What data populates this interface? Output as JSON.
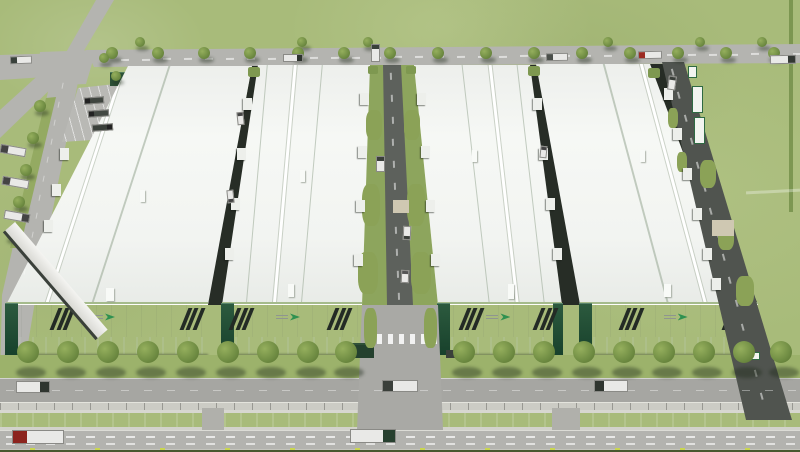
{
  "meta": {
    "label": "Aerial 3D rendering of a logistics industrial park: four white warehouses with dark striped facades and green logo marks, service roads with loading docks and trucks, tree-lined frontage road, concrete wall, teal drainage canal and a main highway"
  },
  "palette": {
    "grass": "#a8bb7a",
    "road_light": "#b4b4b0",
    "road_dark": "#5d615c",
    "roof": "#f6f8f5",
    "facade_base": "#122a1e",
    "stripe": "#232b25",
    "canal": "#35837d",
    "tree": "#6e8b42",
    "logo_green": "#2f9150",
    "curb_marker": "#c9d64f",
    "trailer_green": "#2f6a43"
  },
  "buildings": [
    {
      "name": "warehouse-1",
      "facade_x": 6,
      "facade_w": 202,
      "stripes": [
        0.24,
        0.88
      ],
      "logo": 0.5,
      "left_tower": true,
      "right_tower": false
    },
    {
      "name": "warehouse-2",
      "facade_x": 222,
      "facade_w": 140,
      "stripes": [
        0.08,
        0.78
      ],
      "logo": 0.5,
      "left_tower": true,
      "right_tower": false
    },
    {
      "name": "warehouse-3",
      "facade_x": 438,
      "facade_w": 124,
      "stripes": [
        0.2,
        0.8
      ],
      "logo": 0.52,
      "left_tower": true,
      "right_tower": true
    },
    {
      "name": "warehouse-4",
      "facade_x": 580,
      "facade_w": 178,
      "stripes": [
        0.24,
        0.82
      ],
      "logo": 0.56,
      "left_tower": true,
      "right_tower": false
    }
  ],
  "trees": {
    "rows": [
      {
        "name": "top-road-north",
        "y": 42,
        "r": 5,
        "xs": [
          140,
          302,
          368,
          608,
          700,
          762
        ],
        "shadow": {
          "dx": 2,
          "dy": 6,
          "w": 13,
          "h": 5
        }
      },
      {
        "name": "top-road-south",
        "y": 53,
        "r": 6,
        "xs": [
          112,
          158,
          204,
          250,
          298,
          344,
          390,
          438,
          486,
          534,
          582,
          630,
          678,
          726,
          774
        ],
        "shadow": {
          "dx": 2,
          "dy": 7,
          "w": 15,
          "h": 6
        }
      },
      {
        "name": "median",
        "r": 6,
        "pts": [
          [
            40,
            106
          ],
          [
            33,
            138
          ],
          [
            26,
            170
          ],
          [
            19,
            202
          ],
          [
            12,
            234
          ]
        ],
        "shadow": {
          "dx": 2,
          "dy": 7,
          "w": 14,
          "h": 6
        }
      },
      {
        "name": "intersection",
        "r": 5,
        "pts": [
          [
            104,
            58
          ],
          [
            116,
            76
          ]
        ],
        "shadow": {
          "dx": 2,
          "dy": 6,
          "w": 12,
          "h": 5
        }
      },
      {
        "name": "frontage",
        "y": 352,
        "r": 11,
        "xs": [
          28,
          68,
          108,
          148,
          188,
          228,
          268,
          308,
          346,
          464,
          504,
          544,
          584,
          624,
          664,
          704,
          744,
          781
        ],
        "shadow": {
          "dx": 3,
          "dy": 20,
          "w": 30,
          "h": 11
        }
      }
    ]
  },
  "trucks": [
    {
      "x": 10,
      "y": 56,
      "w": 22,
      "h": 8,
      "rot": -2,
      "cab": "l",
      "cab_color": "#39413b"
    },
    {
      "x": 283,
      "y": 54,
      "w": 20,
      "h": 8,
      "rot": 0,
      "cab": "r",
      "cab_color": "#2e342e"
    },
    {
      "x": 371,
      "y": 44,
      "w": 9,
      "h": 18,
      "rot": 0,
      "cab": "t",
      "cab_color": "#39413b"
    },
    {
      "x": 546,
      "y": 53,
      "w": 22,
      "h": 8,
      "rot": -1,
      "cab": "l",
      "cab_color": "#4a4f4a"
    },
    {
      "x": 638,
      "y": 51,
      "w": 24,
      "h": 8,
      "rot": -1,
      "cab": "l",
      "cab_color": "#9c2b22"
    },
    {
      "x": 770,
      "y": 55,
      "w": 26,
      "h": 9,
      "rot": -1,
      "cab": "r",
      "cab_color": "#333833"
    },
    {
      "x": 0,
      "y": 146,
      "w": 26,
      "h": 9,
      "rot": 10,
      "cab": "l",
      "cab_color": "#444444"
    },
    {
      "x": 2,
      "y": 178,
      "w": 27,
      "h": 9,
      "rot": 10,
      "cab": "l",
      "cab_color": "#444444"
    },
    {
      "x": 4,
      "y": 212,
      "w": 26,
      "h": 9,
      "rot": 10,
      "cab": "r",
      "cab_color": "#444444"
    },
    {
      "x": 84,
      "y": 97,
      "w": 20,
      "h": 7,
      "rot": -4,
      "cab": "l",
      "cab_color": "#222222",
      "body": "#3f453f"
    },
    {
      "x": 88,
      "y": 110,
      "w": 21,
      "h": 7,
      "rot": -4,
      "cab": "l",
      "cab_color": "#222222",
      "body": "#434943"
    },
    {
      "x": 92,
      "y": 124,
      "w": 21,
      "h": 7,
      "rot": -4,
      "cab": "r",
      "cab_color": "#222222",
      "body": "#3a403a"
    },
    {
      "x": 376,
      "y": 156,
      "w": 9,
      "h": 16,
      "rot": 0,
      "cab": "t",
      "cab_color": "#3a3f3a"
    },
    {
      "x": 403,
      "y": 226,
      "w": 8,
      "h": 14,
      "rot": 2,
      "cab": "b",
      "cab_color": "#3a3f3a"
    },
    {
      "x": 401,
      "y": 270,
      "w": 8,
      "h": 13,
      "rot": 2,
      "cab": "t",
      "cab_color": "#555555"
    },
    {
      "x": 237,
      "y": 112,
      "w": 7,
      "h": 13,
      "rot": -6,
      "cab": "t",
      "cab_color": "#444444"
    },
    {
      "x": 227,
      "y": 190,
      "w": 7,
      "h": 13,
      "rot": -6,
      "cab": "b",
      "cab_color": "#444444"
    },
    {
      "x": 540,
      "y": 146,
      "w": 7,
      "h": 12,
      "rot": 6,
      "cab": "t",
      "cab_color": "#444444"
    },
    {
      "x": 668,
      "y": 76,
      "w": 8,
      "h": 14,
      "rot": 8,
      "cab": "t",
      "cab_color": "#3a3f3a"
    },
    {
      "x": 16,
      "y": 381,
      "w": 34,
      "h": 12,
      "rot": 0,
      "cab": "r",
      "cab_color": "#2f352f"
    },
    {
      "x": 382,
      "y": 380,
      "w": 36,
      "h": 12,
      "rot": 0,
      "cab": "l",
      "cab_color": "#3a3f3a"
    },
    {
      "x": 594,
      "y": 380,
      "w": 34,
      "h": 12,
      "rot": 0,
      "cab": "l",
      "cab_color": "#2f352f"
    },
    {
      "x": 12,
      "y": 430,
      "w": 52,
      "h": 14,
      "rot": 0,
      "cab": "l",
      "cab_color": "#8c241e"
    },
    {
      "x": 350,
      "y": 429,
      "w": 46,
      "h": 14,
      "rot": 0,
      "cab": "r",
      "cab_color": "#27402f"
    }
  ],
  "dock_canopies": [
    [
      243,
      98
    ],
    [
      237,
      148
    ],
    [
      231,
      198
    ],
    [
      225,
      248
    ],
    [
      360,
      93
    ],
    [
      358,
      146
    ],
    [
      356,
      200
    ],
    [
      354,
      254
    ],
    [
      417,
      93
    ],
    [
      421,
      146
    ],
    [
      426,
      200
    ],
    [
      431,
      254
    ],
    [
      533,
      98
    ],
    [
      539,
      148
    ],
    [
      546,
      198
    ],
    [
      553,
      248
    ],
    [
      664,
      88
    ],
    [
      673,
      128
    ],
    [
      683,
      168
    ],
    [
      693,
      208
    ],
    [
      703,
      248
    ],
    [
      712,
      278
    ],
    [
      60,
      148
    ],
    [
      52,
      184
    ],
    [
      44,
      220
    ]
  ],
  "grass_patches": [
    [
      366,
      110,
      16,
      30
    ],
    [
      404,
      110,
      16,
      30
    ],
    [
      362,
      184,
      18,
      42
    ],
    [
      407,
      184,
      18,
      42
    ],
    [
      358,
      252,
      20,
      42
    ],
    [
      411,
      252,
      20,
      42
    ],
    [
      700,
      160,
      16,
      28
    ],
    [
      718,
      222,
      16,
      28
    ],
    [
      736,
      276,
      18,
      30
    ],
    [
      668,
      108,
      10,
      20
    ],
    [
      677,
      152,
      10,
      20
    ],
    [
      364,
      308,
      13,
      40
    ],
    [
      424,
      308,
      13,
      40
    ]
  ],
  "paved_pads": [
    [
      712,
      220,
      22,
      16
    ],
    [
      393,
      200,
      16,
      13
    ]
  ],
  "hedge_wedges": [
    [
      248,
      67,
      12,
      10
    ],
    [
      368,
      66,
      10,
      8
    ],
    [
      406,
      66,
      10,
      8
    ],
    [
      528,
      66,
      12,
      10
    ],
    [
      648,
      68,
      12,
      10
    ]
  ],
  "roof_vents": [
    [
      140,
      190,
      5,
      12
    ],
    [
      106,
      288,
      8,
      13
    ],
    [
      300,
      170,
      5,
      12
    ],
    [
      288,
      284,
      6,
      13
    ],
    [
      472,
      150,
      5,
      12
    ],
    [
      508,
      284,
      6,
      15
    ],
    [
      640,
      150,
      5,
      12
    ],
    [
      664,
      284,
      7,
      13
    ]
  ],
  "parked_trailers": [
    [
      692,
      86,
      11,
      27
    ],
    [
      694,
      117,
      11,
      27
    ],
    [
      688,
      66,
      9,
      12
    ],
    [
      748,
      352,
      12,
      8
    ]
  ],
  "dash_lines": [
    {
      "x1": 100,
      "y1": 59,
      "x2": 795,
      "y2": 53,
      "seg": 8,
      "gap": 13,
      "t": 1.5,
      "c": "rgba(255,255,255,.55)"
    },
    {
      "x1": 391,
      "y1": 72,
      "x2": 399,
      "y2": 298,
      "seg": 7,
      "gap": 15,
      "t": 1.6,
      "c": "rgba(255,255,255,.5)"
    },
    {
      "x1": 672,
      "y1": 68,
      "x2": 766,
      "y2": 410,
      "seg": 7,
      "gap": 17,
      "t": 1.6,
      "c": "rgba(255,255,255,.5)"
    },
    {
      "x1": 6,
      "y1": 436,
      "x2": 794,
      "y2": 436,
      "seg": 9,
      "gap": 11,
      "t": 1.8,
      "c": "rgba(255,255,255,.7)"
    },
    {
      "x1": 6,
      "y1": 443,
      "x2": 794,
      "y2": 443,
      "seg": 9,
      "gap": 11,
      "t": 1.8,
      "c": "rgba(255,255,255,.6)"
    },
    {
      "x1": 6,
      "y1": 390,
      "x2": 794,
      "y2": 390,
      "seg": 8,
      "gap": 15,
      "t": 1.4,
      "c": "rgba(255,255,255,.38)"
    },
    {
      "x1": 63,
      "y1": 82,
      "x2": 22,
      "y2": 285,
      "seg": 6,
      "gap": 13,
      "t": 1.4,
      "c": "rgba(255,255,255,.4)"
    }
  ],
  "zebra": {
    "x": 366,
    "y": 334,
    "step": 11,
    "count": 7,
    "w": 5,
    "h": 10
  },
  "curb_markers": {
    "y": 447.5,
    "xs": [
      30,
      95,
      160,
      225,
      290,
      355,
      420,
      485,
      550,
      615,
      680,
      745
    ]
  },
  "canal_crossings": [
    [
      202,
      408,
      22,
      24
    ],
    [
      552,
      408,
      28,
      24
    ]
  ]
}
